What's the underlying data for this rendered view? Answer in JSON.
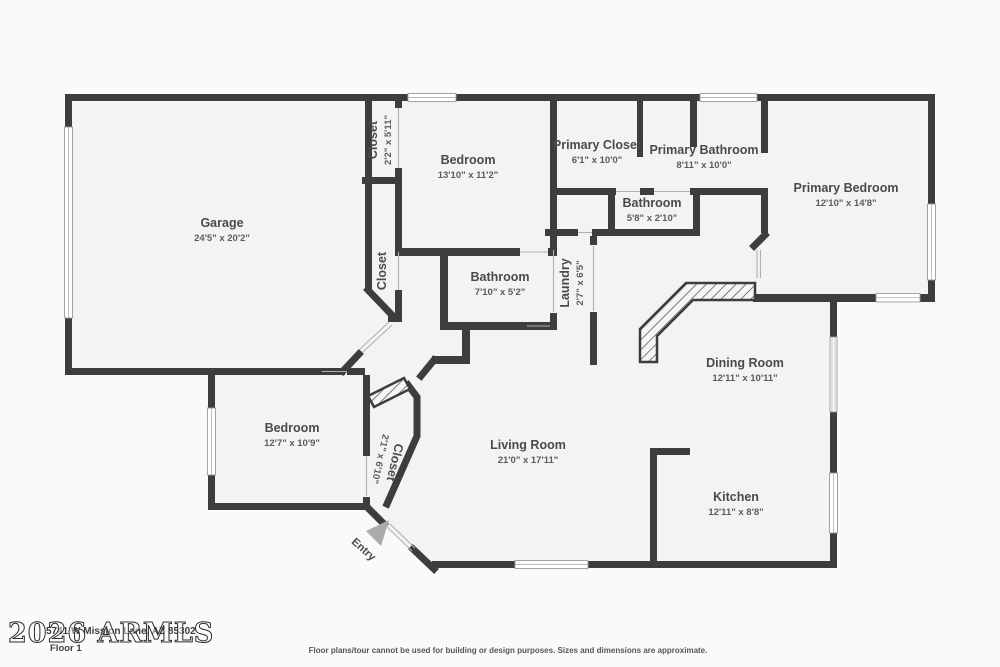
{
  "plan": {
    "rooms": [
      {
        "name": "Garage",
        "dims": "24'5\" x 20'2\"",
        "cx": 222,
        "cy": 229,
        "rot": 0
      },
      {
        "name": "Closet",
        "dims": "2'2\" x 5'11\"",
        "cx": 379,
        "cy": 140,
        "rot": -90
      },
      {
        "name": "Bedroom",
        "dims": "13'10\" x 11'2\"",
        "cx": 468,
        "cy": 166,
        "rot": 0
      },
      {
        "name": "Primary Closet",
        "dims": "6'1\" x 10'0\"",
        "cx": 597,
        "cy": 151,
        "rot": 0
      },
      {
        "name": "Primary Bathroom",
        "dims": "8'11\" x 10'0\"",
        "cx": 704,
        "cy": 156,
        "rot": 0
      },
      {
        "name": "Primary Bedroom",
        "dims": "12'10\" x 14'8\"",
        "cx": 846,
        "cy": 194,
        "rot": 0
      },
      {
        "name": "Bathroom",
        "dims": "5'8\" x 2'10\"",
        "cx": 652,
        "cy": 209,
        "rot": 0
      },
      {
        "name": "Closet",
        "dims": "",
        "cx": 382,
        "cy": 271,
        "rot": -90
      },
      {
        "name": "Bathroom",
        "dims": "7'10\" x 5'2\"",
        "cx": 500,
        "cy": 283,
        "rot": 0
      },
      {
        "name": "Laundry",
        "dims": "2'7\" x 6'5\"",
        "cx": 571,
        "cy": 283,
        "rot": -90
      },
      {
        "name": "Dining Room",
        "dims": "12'11\" x 10'11\"",
        "cx": 745,
        "cy": 369,
        "rot": 0
      },
      {
        "name": "Bedroom",
        "dims": "12'7\" x 10'9\"",
        "cx": 292,
        "cy": 434,
        "rot": 0
      },
      {
        "name": "Closet",
        "dims": "2'1\" x 6'10\"",
        "cx": 389,
        "cy": 461,
        "rot": 103
      },
      {
        "name": "Living Room",
        "dims": "21'0\" x 17'11\"",
        "cx": 528,
        "cy": 451,
        "rot": 0
      },
      {
        "name": "Kitchen",
        "dims": "12'11\" x 8'8\"",
        "cx": 736,
        "cy": 503,
        "rot": 0
      },
      {
        "name": "Entry",
        "dims": "",
        "cx": 364,
        "cy": 549,
        "rot": 42,
        "small": true
      }
    ],
    "footer": {
      "watermark": "2026 ARMLS",
      "address": "5741 W Mission Lane, AZ 85302",
      "floor_label": "Floor 1",
      "disclaimer": "Floor plans/tour cannot be used for building or design purposes. Sizes and dimensions are approximate."
    },
    "colors": {
      "wall": "#3d3d3d",
      "room_fill": "#f3f3f3",
      "background": "#fafafa",
      "label": "#4a4a4a",
      "dims": "#5c5c5c",
      "window": "#ffffff",
      "entry_arrow": "#ababab"
    }
  }
}
